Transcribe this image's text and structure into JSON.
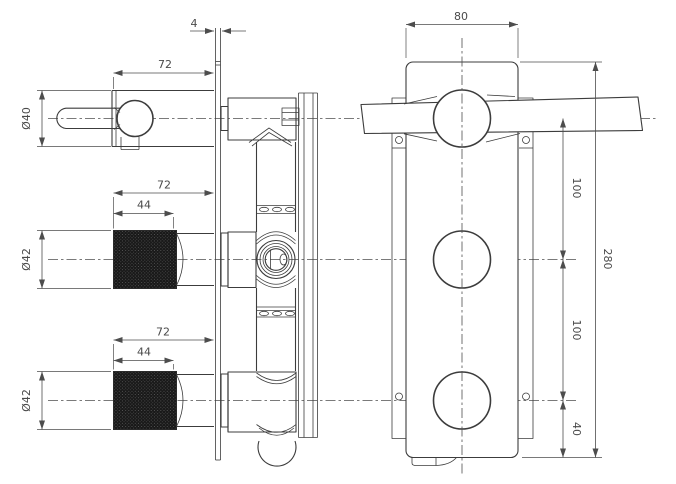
{
  "drawing": {
    "background": "#ffffff",
    "line_color": "#3c3c3c",
    "dim_text_color": "#4a4a4a",
    "knurl_fill_color": "#191919",
    "side_view": {
      "dims": {
        "plate_thickness": "4",
        "lever_assembly_length": "72",
        "lever_body_diameter": "Ø40",
        "middle_knob_length": "72",
        "middle_knob_knurl_length": "44",
        "middle_knob_diameter": "Ø42",
        "bottom_knob_length": "72",
        "bottom_knob_knurl_length": "44",
        "bottom_knob_diameter": "Ø42"
      }
    },
    "front_view": {
      "dims": {
        "plate_width": "80",
        "lever_to_middle_spacing": "100",
        "middle_to_bottom_spacing": "100",
        "bottom_circle_to_edge": "40",
        "plate_height": "280"
      }
    }
  }
}
